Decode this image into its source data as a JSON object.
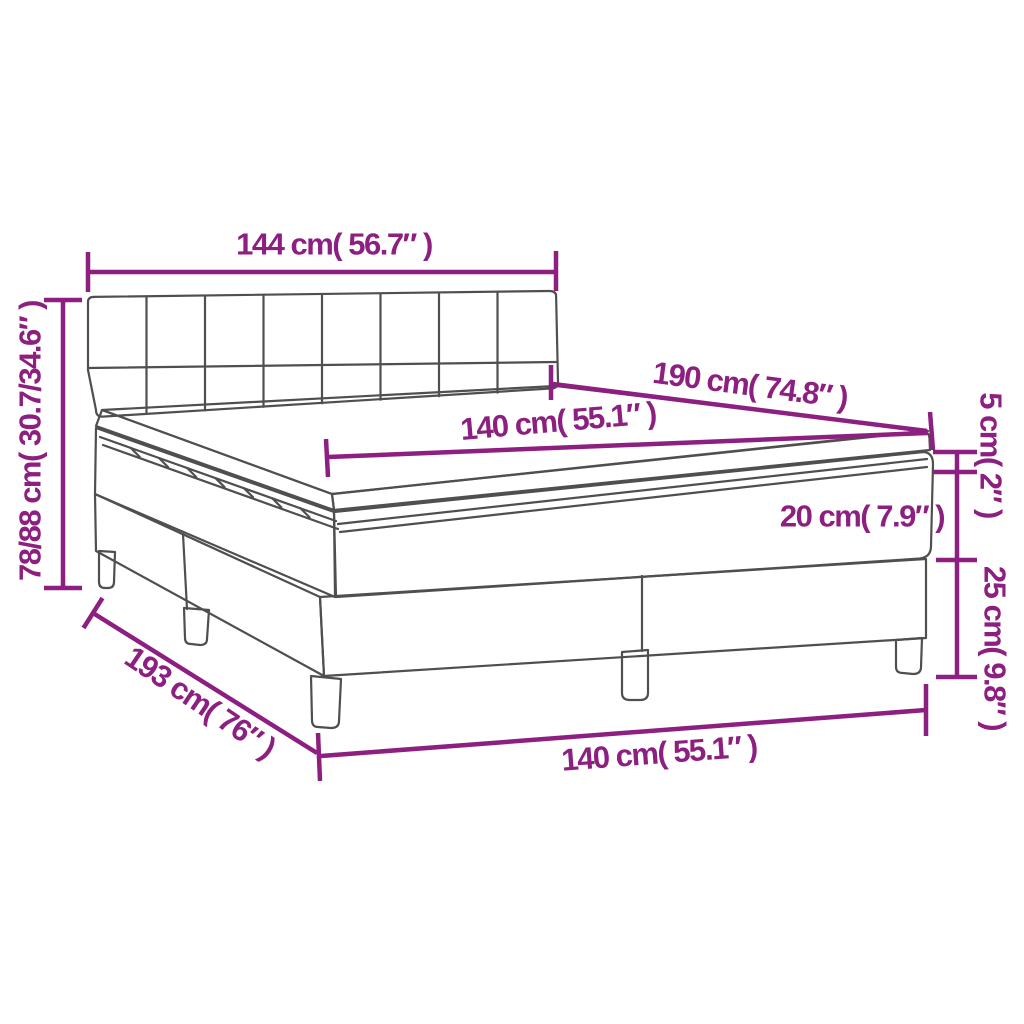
{
  "diagram": {
    "product": "box spring bed with mattress and topper - dimension diagram",
    "labels": {
      "headboard_width": "144 cm( 56.7″ )",
      "total_height": "78/88 cm( 30.7/34.6″ )",
      "mattress_length": "190 cm( 74.8″ )",
      "mattress_width": "140 cm( 55.1″ )",
      "mattress_thickness": "20 cm( 7.9″ )",
      "topper_thickness": "5 cm( 2″ )",
      "base_height": "25 cm( 9.8″ )",
      "base_length": "193 cm( 76″ )",
      "base_width": "140 cm( 55.1″ )"
    }
  },
  "colors": {
    "accent": "#8c1f80",
    "line": "#4f4f4f",
    "background": "#ffffff"
  }
}
